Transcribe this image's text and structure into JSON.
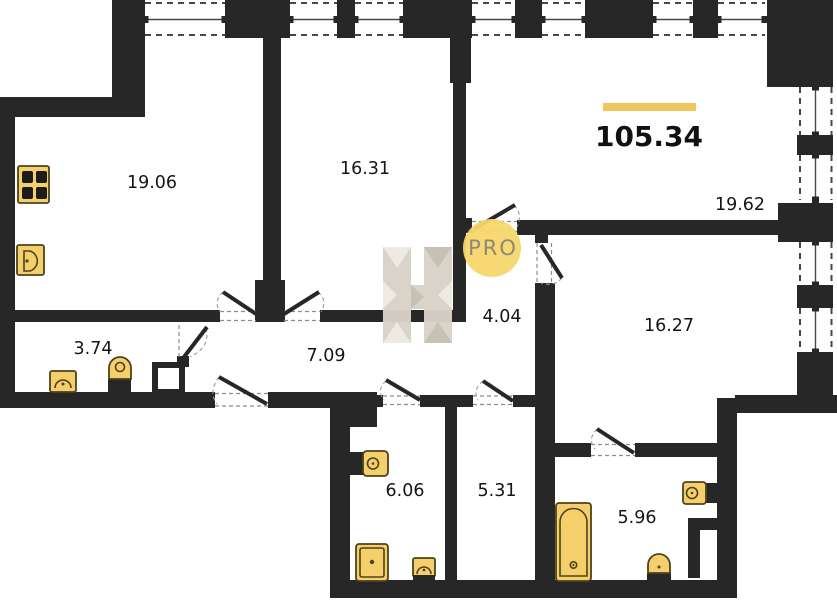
{
  "plan": {
    "total": {
      "value": "105.34"
    },
    "badge": {
      "text": "PRO"
    },
    "rooms": {
      "r19_06": {
        "area": "19.06"
      },
      "r16_31": {
        "area": "16.31"
      },
      "r19_62": {
        "area": "19.62"
      },
      "r16_27": {
        "area": "16.27"
      },
      "r4_04": {
        "area": "4.04"
      },
      "r7_09": {
        "area": "7.09"
      },
      "r3_74": {
        "area": "3.74"
      },
      "r6_06": {
        "area": "6.06"
      },
      "r5_31": {
        "area": "5.31"
      },
      "r5_96": {
        "area": "5.96"
      }
    },
    "icons": [
      "stove-icon",
      "sink-icon",
      "toilet-icon",
      "bathtub-icon",
      "washing-machine-icon",
      "h-logo-watermark",
      "pro-badge"
    ]
  },
  "colors": {
    "wall": "#272727",
    "accent": "#f0c75a",
    "fixture_fill": "#f6cf6d",
    "fixture_stroke": "#4d421a",
    "badge_bg": "#f7d66b",
    "badge_text": "#8f887a",
    "wm_base": "#d9d2c9",
    "wm_light": "#edeae4",
    "wm_dark": "#c6beb2",
    "label": "#161616"
  }
}
